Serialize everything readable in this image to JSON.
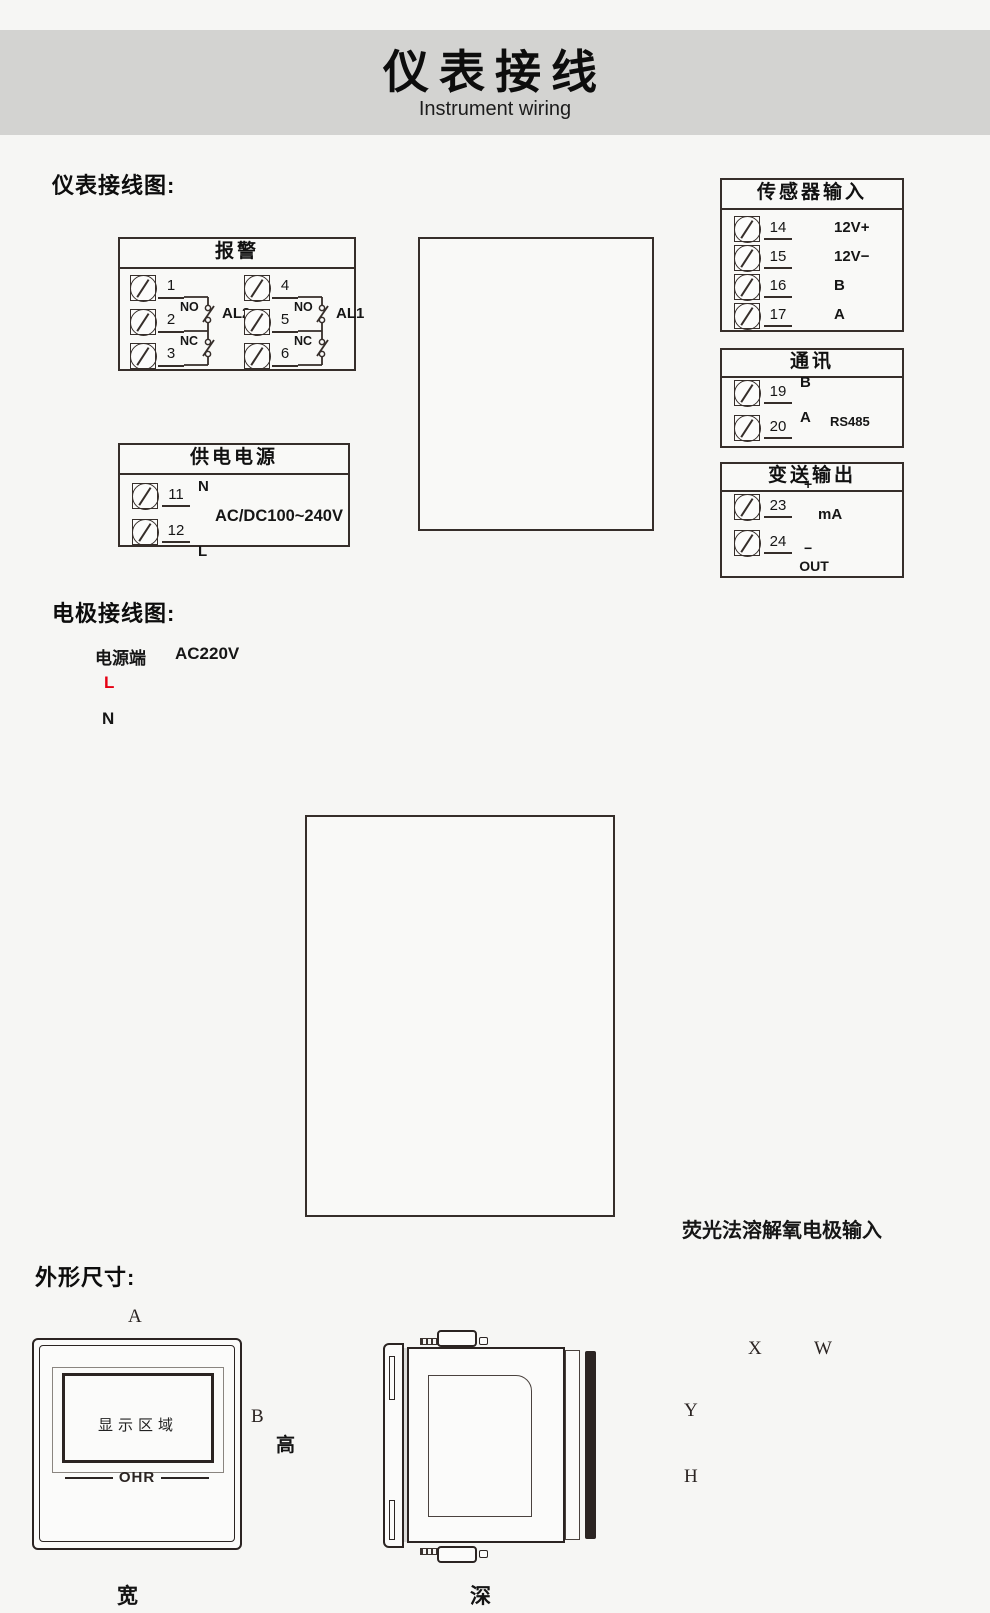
{
  "header": {
    "title": "仪表接线",
    "subtitle": "Instrument wiring"
  },
  "section_labels": {
    "wiring": "仪表接线图:",
    "electrode": "电极接线图:",
    "dimensions": "外形尺寸:"
  },
  "alarm_box": {
    "title": "报警",
    "groups": [
      {
        "terminals": [
          "1",
          "2",
          "3"
        ],
        "no_label": "NO",
        "nc_label": "NC",
        "name": "AL2"
      },
      {
        "terminals": [
          "4",
          "5",
          "6"
        ],
        "no_label": "NO",
        "nc_label": "NC",
        "name": "AL1"
      }
    ]
  },
  "power_box": {
    "title": "供电电源",
    "rows": [
      {
        "num": "11",
        "label": "N"
      },
      {
        "num": "12",
        "label": "L"
      }
    ],
    "voltage": "AC/DC100~240V"
  },
  "sensor_box": {
    "title": "传感器输入",
    "rows": [
      {
        "num": "14",
        "label": "12V+"
      },
      {
        "num": "15",
        "label": "12V−"
      },
      {
        "num": "16",
        "label": "B"
      },
      {
        "num": "17",
        "label": "A"
      }
    ]
  },
  "comm_box": {
    "title": "通讯",
    "rows": [
      {
        "num": "19",
        "label": "B"
      },
      {
        "num": "20",
        "label": "A"
      }
    ],
    "protocol": "RS485"
  },
  "output_box": {
    "title": "变送输出",
    "rows": [
      {
        "num": "23"
      },
      {
        "num": "24"
      }
    ],
    "plus": "+",
    "minus": "−",
    "unit": "mA",
    "out": "OUT"
  },
  "terminal_numbers": {
    "left": [
      "1",
      "2",
      "3",
      "4",
      "5",
      "6",
      "7",
      "8",
      "9",
      "10",
      "11",
      "12"
    ],
    "right": [
      "13",
      "14",
      "15",
      "16",
      "17",
      "18",
      "19",
      "20",
      "21",
      "22",
      "23",
      "24"
    ]
  },
  "electrode": {
    "source_label": "电源端",
    "voltage": "AC220V",
    "live": "L",
    "neutral": "N",
    "live_color": "#e60012",
    "neutral_color": "#231815",
    "wires": [
      {
        "terminal": "14",
        "label": "12V+",
        "color": "#e60012"
      },
      {
        "terminal": "15",
        "label": "12V−",
        "color": "#231815"
      },
      {
        "terminal": "16",
        "label": "B",
        "color": "#00a23f"
      },
      {
        "terminal": "17",
        "label": "A",
        "color": "#b5b5b5"
      }
    ],
    "probe_label": "荧光法溶解氧电极输入"
  },
  "front_view": {
    "dim_a": "A",
    "dim_b": "B",
    "height_label": "高",
    "width_label": "宽",
    "display_label": "显示区域",
    "brand": "OHR",
    "buttons": [
      "↺",
      "◀",
      "▼",
      "▲"
    ]
  },
  "side_view": {
    "depth_label": "深"
  },
  "cutout": {
    "dim_x": "X",
    "dim_w": "W",
    "dim_y": "Y",
    "dim_h": "H"
  }
}
